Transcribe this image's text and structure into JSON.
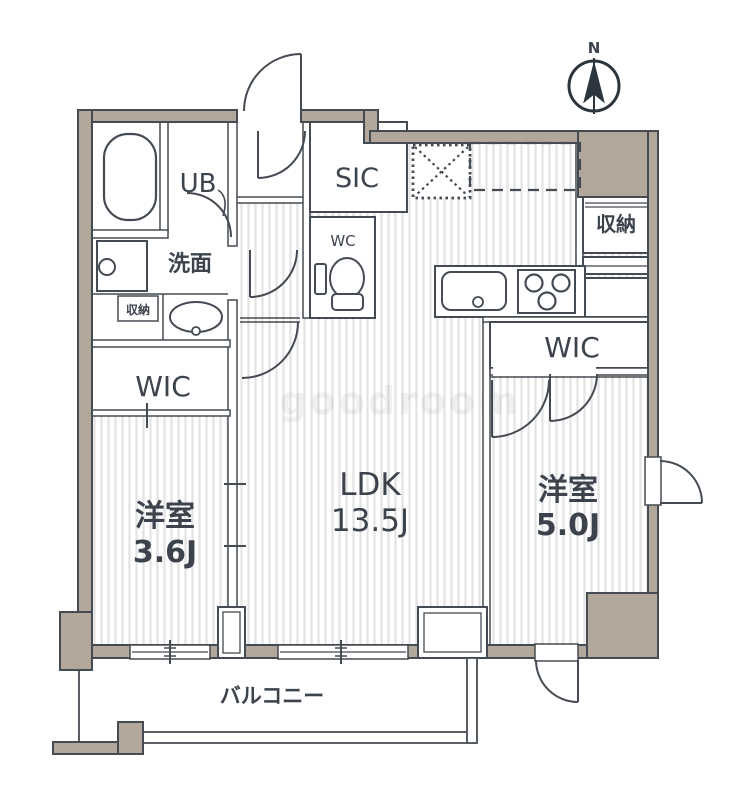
{
  "floorplan": {
    "compass_label": "N",
    "watermark": "goodroom",
    "balcony_label": "バルコニー",
    "rooms": {
      "ldk": {
        "name": "LDK",
        "area": "13.5J"
      },
      "bedroom_left": {
        "name": "洋室",
        "area": "3.6J"
      },
      "bedroom_right": {
        "name": "洋室",
        "area": "5.0J"
      },
      "wic_left": {
        "name": "WIC"
      },
      "wic_right": {
        "name": "WIC"
      },
      "sic": {
        "name": "SIC"
      },
      "wc": {
        "name": "WC"
      },
      "unit_bath": {
        "name": "UB"
      },
      "washroom": {
        "name": "洗面"
      },
      "storage_right": {
        "name": "収納"
      },
      "storage_washroom": {
        "name": "収納"
      }
    },
    "colors": {
      "wall_fill": "#b2a79b",
      "line": "#454b52",
      "stripe": "#e3e3e3",
      "text": "#3c434c"
    }
  }
}
